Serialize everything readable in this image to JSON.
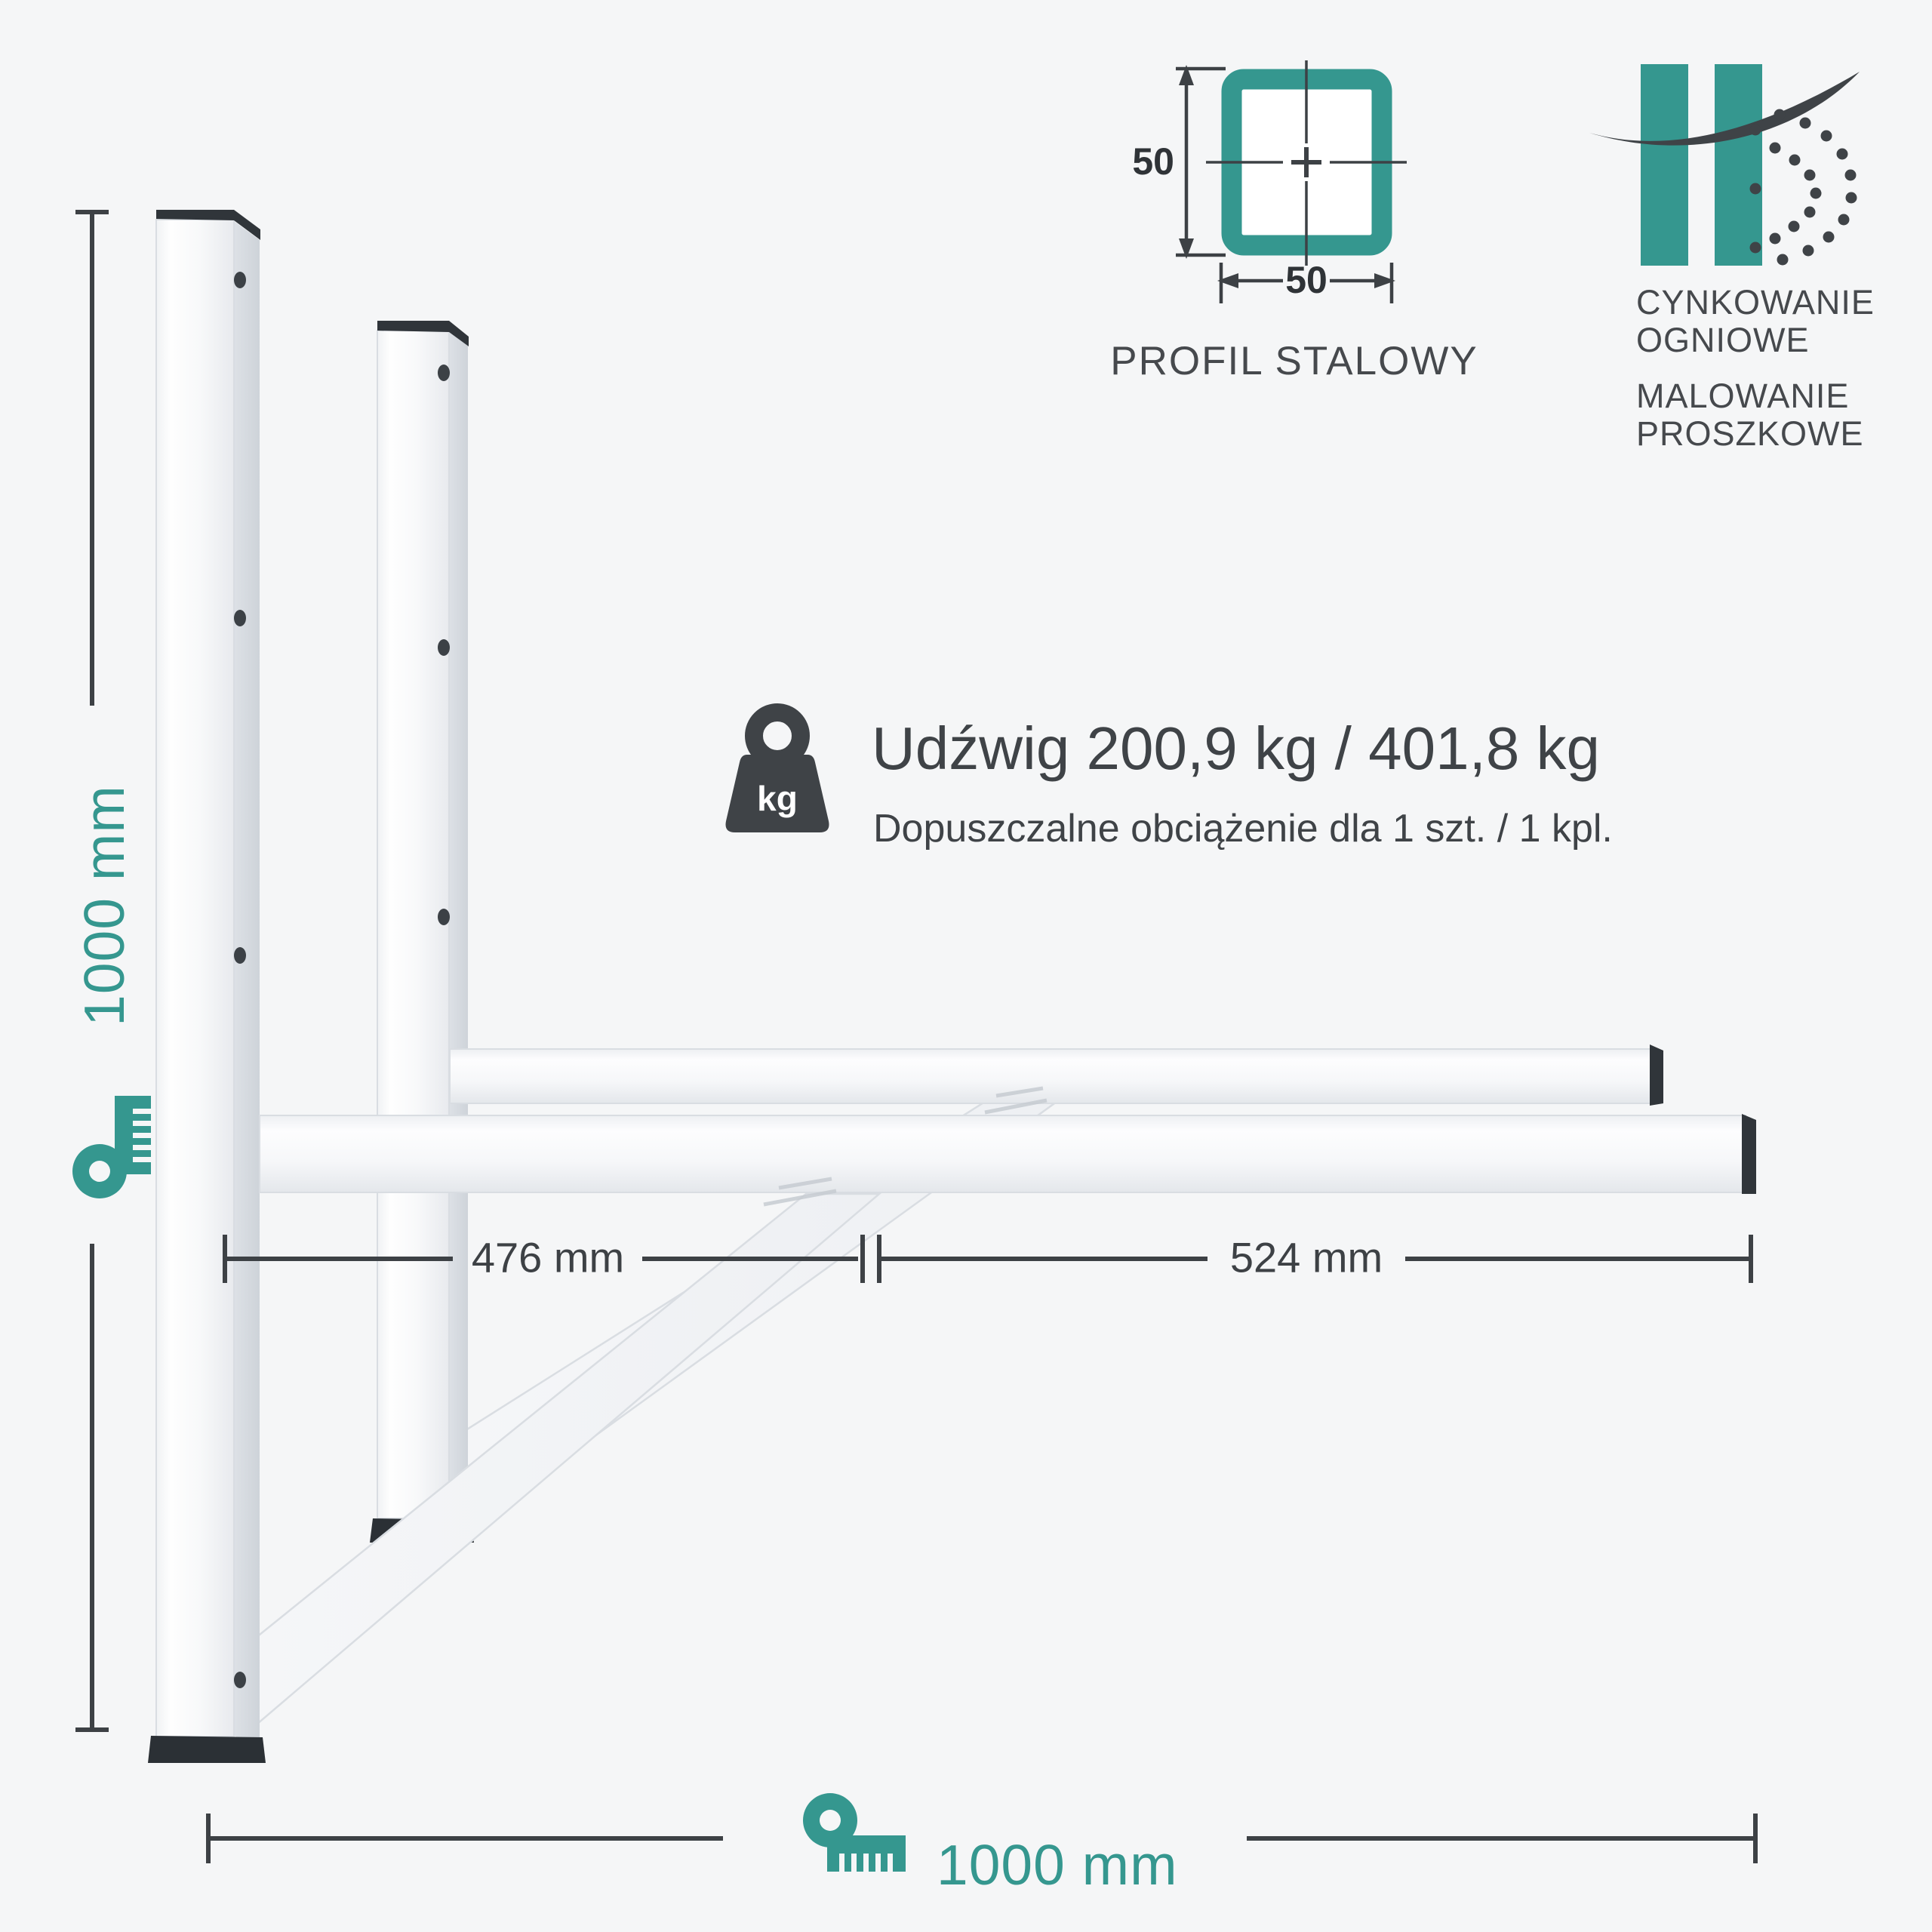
{
  "colors": {
    "teal": "#35978f",
    "dark_text": "#3f4347",
    "dimension_line": "#3d4145",
    "background": "#f5f6f7",
    "bracket_white": "#fdfdfe",
    "end_cap_dark": "#30353a"
  },
  "dimensions": {
    "height": {
      "label": "1000 mm"
    },
    "width_total": {
      "label": "1000 mm"
    },
    "depth_rear": {
      "label": "476 mm"
    },
    "depth_front": {
      "label": "524 mm"
    }
  },
  "profile": {
    "caption": "PROFIL STALOWY",
    "size_width": "50",
    "size_height": "50"
  },
  "coatings": [
    {
      "line1": "CYNKOWANIE",
      "line2": "OGNIOWE"
    },
    {
      "line1": "MALOWANIE",
      "line2": "PROSZKOWE"
    }
  ],
  "load": {
    "badge": "kg",
    "title": "Udźwig 200,9 kg / 401,8 kg",
    "subtitle": "Dopuszczalne obciążenie dla 1 szt. / 1 kpl."
  }
}
